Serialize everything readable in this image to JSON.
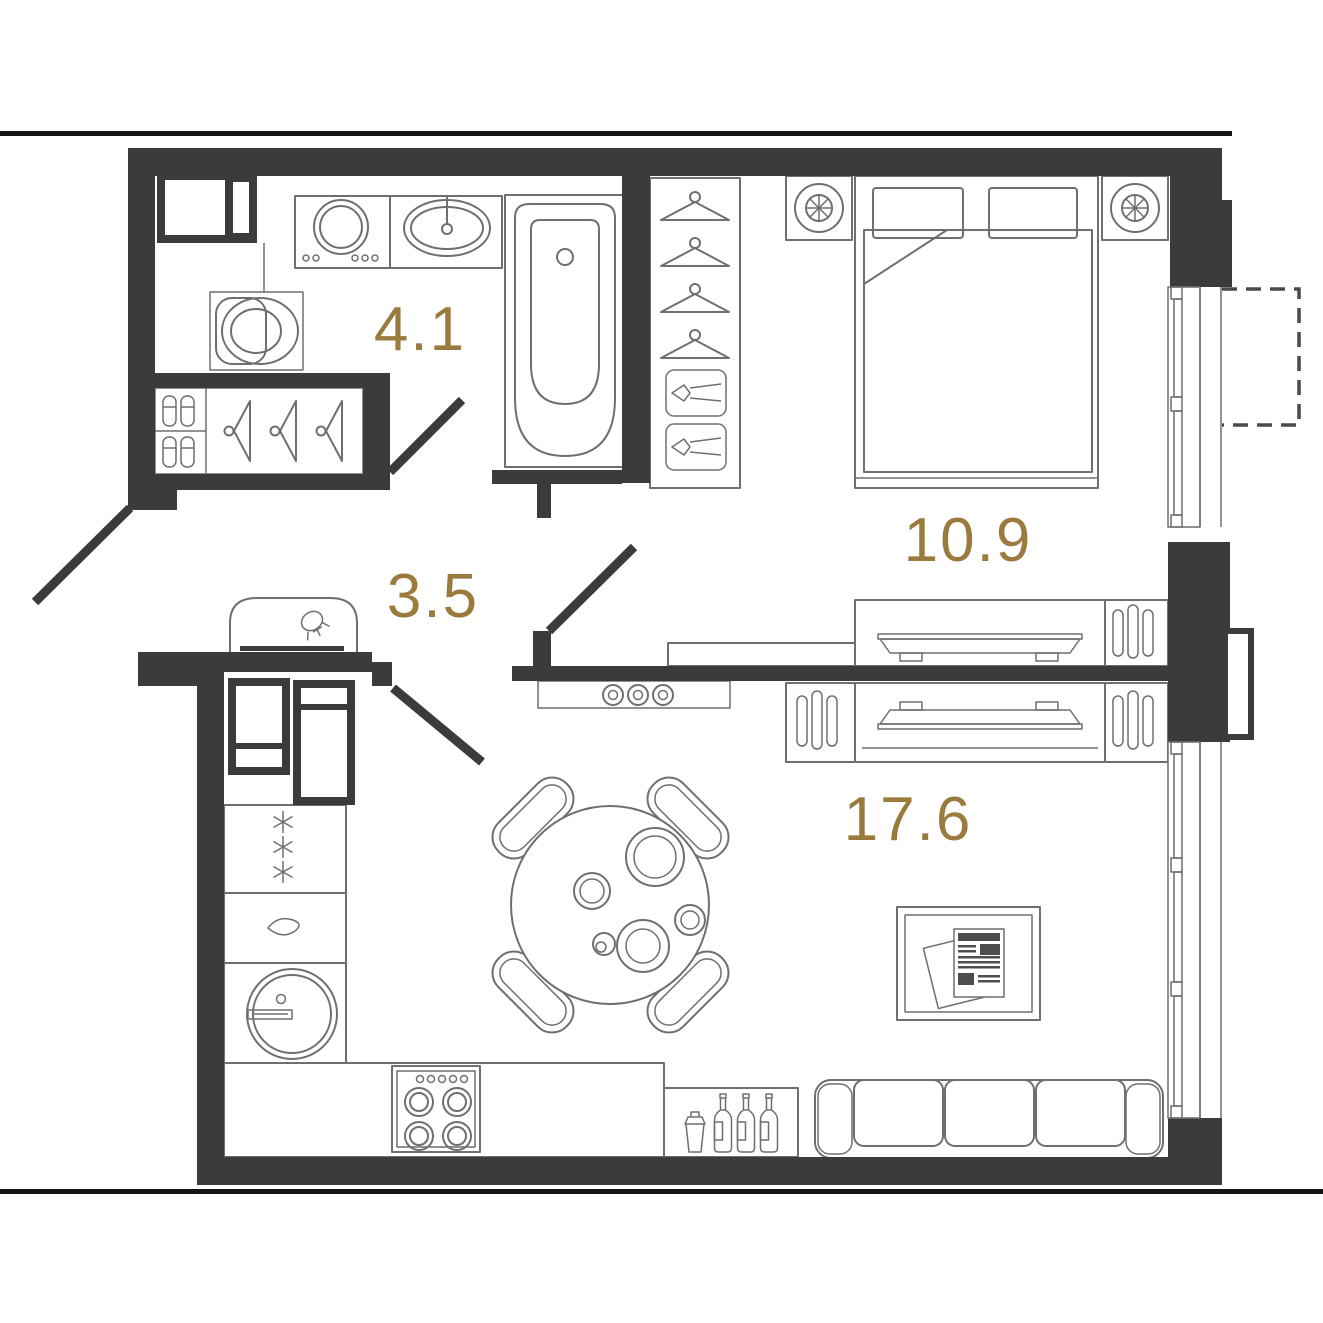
{
  "plan_title": "one-room apartment floor plan",
  "colors": {
    "wall": "#3b3b3c",
    "line": "#6f6f6f",
    "label": "#9b7b3d",
    "section": "#141414",
    "bg": "#ffffff"
  },
  "rooms": {
    "bathroom": {
      "area": "4.1",
      "icons": [
        "washer-cabinet-icon",
        "washing-machine-icon",
        "countertop-sink-icon",
        "toilet-icon",
        "bathtub-icon",
        "hanger-icon",
        "slippers-icon"
      ]
    },
    "hallway": {
      "area": "3.5",
      "icons": [
        "console-with-lamp-icon",
        "coat-hooks-icon"
      ]
    },
    "bedroom": {
      "area": "10.9",
      "icons": [
        "double-bed-icon",
        "pillow-icon",
        "nightstand-lamp-icon",
        "wardrobe-hanger-icon",
        "folded-clothes-icon",
        "tv-console-icon",
        "radiator-icon",
        "window",
        "balcony-dashed-outline"
      ]
    },
    "living_kitchen": {
      "area": "17.6",
      "icons": [
        "fridge-icon",
        "freezer-icon",
        "dishwasher-icon",
        "kitchen-sink-icon",
        "cooktop-icon",
        "bar-bottles-icon",
        "shaker-icon",
        "dining-table-icon",
        "chair-icon",
        "plates-icon",
        "sofa-icon",
        "coffee-table-icon",
        "newspaper-icon",
        "tv-console-icon",
        "radiator-icon",
        "window"
      ]
    }
  },
  "doors": [
    "entry-door",
    "bathroom-door",
    "bedroom-door",
    "kitchen-door"
  ]
}
